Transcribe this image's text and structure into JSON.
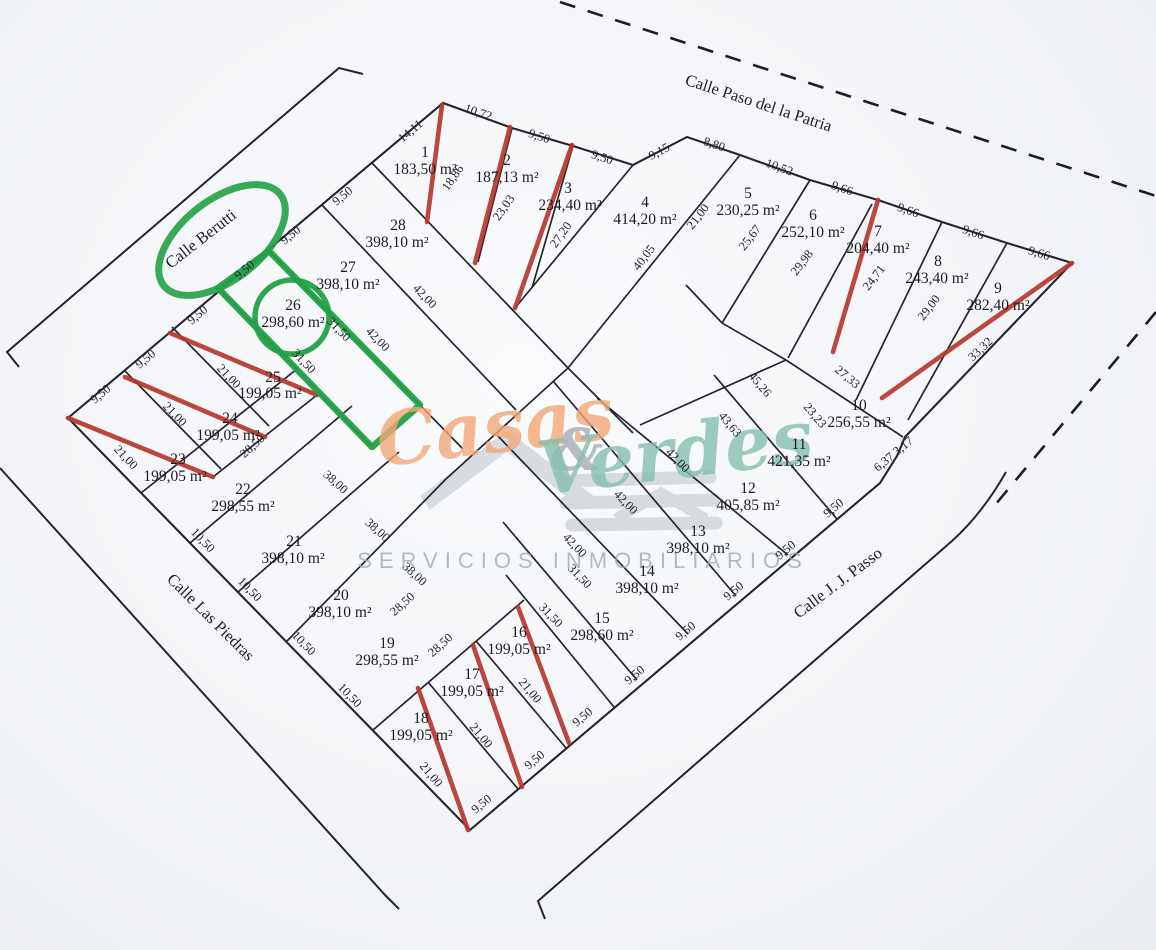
{
  "streets": [
    {
      "name": "Calle Paso del la Patria"
    },
    {
      "name": "Calle Berutti"
    },
    {
      "name": "Calle Las Piedras"
    },
    {
      "name": "Calle J. J. Passo"
    }
  ],
  "watermark": {
    "word1": "Casas",
    "amp": "&",
    "word2": "Verdes",
    "caption": "SERVICIOS INMOBILIARIOS"
  },
  "colors": {
    "ink": "#25252e",
    "sold": "#b6372c",
    "highlight": "#22a146",
    "wm_orange": "#f2a878",
    "wm_teal": "#86bfae",
    "wm_gray": "#a6adb6"
  },
  "lots": [
    {
      "num": "1",
      "area": "183,50 m²",
      "nx": 425,
      "ny": 157,
      "ax": 425,
      "ay": 174,
      "sold": true,
      "highlighted": false
    },
    {
      "num": "2",
      "area": "187,13 m²",
      "nx": 507,
      "ny": 165,
      "ax": 507,
      "ay": 182,
      "sold": true,
      "highlighted": false
    },
    {
      "num": "3",
      "area": "234,40 m²",
      "nx": 568,
      "ny": 193,
      "ax": 570,
      "ay": 210,
      "sold": true,
      "highlighted": false
    },
    {
      "num": "4",
      "area": "414,20 m²",
      "nx": 645,
      "ny": 207,
      "ax": 645,
      "ay": 224,
      "sold": false,
      "highlighted": false
    },
    {
      "num": "5",
      "area": "230,25 m²",
      "nx": 748,
      "ny": 198,
      "ax": 748,
      "ay": 215,
      "sold": false,
      "highlighted": false
    },
    {
      "num": "6",
      "area": "252,10 m²",
      "nx": 813,
      "ny": 220,
      "ax": 813,
      "ay": 237,
      "sold": false,
      "highlighted": false
    },
    {
      "num": "7",
      "area": "204,40 m²",
      "nx": 878,
      "ny": 236,
      "ax": 878,
      "ay": 253,
      "sold": true,
      "highlighted": false
    },
    {
      "num": "8",
      "area": "243,40 m²",
      "nx": 938,
      "ny": 266,
      "ax": 937,
      "ay": 283,
      "sold": false,
      "highlighted": false
    },
    {
      "num": "9",
      "area": "282,40 m²",
      "nx": 998,
      "ny": 293,
      "ax": 998,
      "ay": 310,
      "sold": true,
      "highlighted": false
    },
    {
      "num": "10",
      "area": "256,55 m²",
      "nx": 859,
      "ny": 410,
      "ax": 859,
      "ay": 427,
      "sold": false,
      "highlighted": false
    },
    {
      "num": "11",
      "area": "421,35 m²",
      "nx": 799,
      "ny": 449,
      "ax": 799,
      "ay": 466,
      "sold": false,
      "highlighted": false
    },
    {
      "num": "12",
      "area": "405,85 m²",
      "nx": 748,
      "ny": 493,
      "ax": 748,
      "ay": 510,
      "sold": false,
      "highlighted": false
    },
    {
      "num": "13",
      "area": "398,10 m²",
      "nx": 698,
      "ny": 536,
      "ax": 698,
      "ay": 553,
      "sold": false,
      "highlighted": false
    },
    {
      "num": "14",
      "area": "398,10 m²",
      "nx": 647,
      "ny": 576,
      "ax": 647,
      "ay": 593,
      "sold": false,
      "highlighted": false
    },
    {
      "num": "15",
      "area": "298,60 m²",
      "nx": 602,
      "ny": 623,
      "ax": 602,
      "ay": 640,
      "sold": false,
      "highlighted": false
    },
    {
      "num": "16",
      "area": "199,05 m²",
      "nx": 519,
      "ny": 637,
      "ax": 519,
      "ay": 654,
      "sold": true,
      "highlighted": false
    },
    {
      "num": "17",
      "area": "199,05 m²",
      "nx": 472,
      "ny": 679,
      "ax": 472,
      "ay": 696,
      "sold": true,
      "highlighted": false
    },
    {
      "num": "18",
      "area": "199,05 m²",
      "nx": 421,
      "ny": 723,
      "ax": 421,
      "ay": 740,
      "sold": true,
      "highlighted": false
    },
    {
      "num": "19",
      "area": "298,55 m²",
      "nx": 387,
      "ny": 648,
      "ax": 387,
      "ay": 665,
      "sold": false,
      "highlighted": false
    },
    {
      "num": "20",
      "area": "398,10 m²",
      "nx": 341,
      "ny": 600,
      "ax": 340,
      "ay": 617,
      "sold": false,
      "highlighted": false
    },
    {
      "num": "21",
      "area": "398,10 m²",
      "nx": 294,
      "ny": 546,
      "ax": 293,
      "ay": 563,
      "sold": false,
      "highlighted": false
    },
    {
      "num": "22",
      "area": "298,55 m²",
      "nx": 243,
      "ny": 494,
      "ax": 243,
      "ay": 511,
      "sold": false,
      "highlighted": false
    },
    {
      "num": "23",
      "area": "199,05 m²",
      "nx": 178,
      "ny": 464,
      "ax": 175,
      "ay": 481,
      "sold": true,
      "highlighted": false
    },
    {
      "num": "24",
      "area": "199,05 m²",
      "nx": 230,
      "ny": 423,
      "ax": 228,
      "ay": 440,
      "sold": true,
      "highlighted": false
    },
    {
      "num": "25",
      "area": "199,05 m²",
      "nx": 273,
      "ny": 382,
      "ax": 270,
      "ay": 398,
      "sold": true,
      "highlighted": false
    },
    {
      "num": "26",
      "area": "298,60 m²",
      "nx": 293,
      "ny": 310,
      "ax": 293,
      "ay": 327,
      "sold": false,
      "highlighted": true
    },
    {
      "num": "27",
      "area": "398,10 m²",
      "nx": 348,
      "ny": 272,
      "ax": 348,
      "ay": 289,
      "sold": false,
      "highlighted": false
    },
    {
      "num": "28",
      "area": "398,10 m²",
      "nx": 398,
      "ny": 230,
      "ax": 397,
      "ay": 247,
      "sold": false,
      "highlighted": false
    }
  ],
  "dimensions": [
    {
      "t": "9,50",
      "x": 103,
      "y": 397,
      "r": -40
    },
    {
      "t": "9,50",
      "x": 148,
      "y": 362,
      "r": -40
    },
    {
      "t": "9,50",
      "x": 200,
      "y": 318,
      "r": -40
    },
    {
      "t": "9,50",
      "x": 247,
      "y": 273,
      "r": -40
    },
    {
      "t": "9,50",
      "x": 293,
      "y": 238,
      "r": -40
    },
    {
      "t": "9,50",
      "x": 345,
      "y": 199,
      "r": -40
    },
    {
      "t": "14,11",
      "x": 413,
      "y": 134,
      "r": -40
    },
    {
      "t": "10,72",
      "x": 477,
      "y": 116,
      "r": 19
    },
    {
      "t": "9,50",
      "x": 538,
      "y": 140,
      "r": 19
    },
    {
      "t": "9,50",
      "x": 601,
      "y": 161,
      "r": 19
    },
    {
      "t": "9,15",
      "x": 661,
      "y": 155,
      "r": -28
    },
    {
      "t": "8,80",
      "x": 713,
      "y": 148,
      "r": 19
    },
    {
      "t": "10,52",
      "x": 778,
      "y": 171,
      "r": 20
    },
    {
      "t": "9,66",
      "x": 841,
      "y": 192,
      "r": 19
    },
    {
      "t": "9,66",
      "x": 907,
      "y": 214,
      "r": 19
    },
    {
      "t": "9,66",
      "x": 972,
      "y": 236,
      "r": 19
    },
    {
      "t": "9,66",
      "x": 1038,
      "y": 257,
      "r": 17
    },
    {
      "t": "33,32",
      "x": 983,
      "y": 352,
      "r": -43
    },
    {
      "t": "18,86",
      "x": 456,
      "y": 180,
      "r": -55
    },
    {
      "t": "23,03",
      "x": 507,
      "y": 210,
      "r": -55
    },
    {
      "t": "27,20",
      "x": 564,
      "y": 237,
      "r": -55
    },
    {
      "t": "40,05",
      "x": 647,
      "y": 260,
      "r": -52
    },
    {
      "t": "21,00",
      "x": 701,
      "y": 219,
      "r": -52
    },
    {
      "t": "25,67",
      "x": 753,
      "y": 240,
      "r": -52
    },
    {
      "t": "29,98",
      "x": 805,
      "y": 265,
      "r": -52
    },
    {
      "t": "24,71",
      "x": 877,
      "y": 280,
      "r": -52
    },
    {
      "t": "29,00",
      "x": 932,
      "y": 310,
      "r": -52
    },
    {
      "t": "27,33",
      "x": 845,
      "y": 380,
      "r": 40
    },
    {
      "t": "23,23",
      "x": 812,
      "y": 418,
      "r": 50
    },
    {
      "t": "6,37 3,17",
      "x": 896,
      "y": 457,
      "r": -40
    },
    {
      "t": "45,26",
      "x": 757,
      "y": 387,
      "r": 50
    },
    {
      "t": "43,63",
      "x": 727,
      "y": 427,
      "r": 50
    },
    {
      "t": "42,00",
      "x": 422,
      "y": 299,
      "r": 46
    },
    {
      "t": "42,00",
      "x": 375,
      "y": 342,
      "r": 46
    },
    {
      "t": "42,00",
      "x": 675,
      "y": 463,
      "r": 46
    },
    {
      "t": "42,00",
      "x": 623,
      "y": 505,
      "r": 46
    },
    {
      "t": "42,00",
      "x": 572,
      "y": 548,
      "r": 46
    },
    {
      "t": "31,50",
      "x": 336,
      "y": 332,
      "r": 46
    },
    {
      "t": "31,50",
      "x": 301,
      "y": 364,
      "r": 46
    },
    {
      "t": "31,50",
      "x": 577,
      "y": 579,
      "r": 46
    },
    {
      "t": "31,50",
      "x": 548,
      "y": 618,
      "r": 46
    },
    {
      "t": "38,00",
      "x": 333,
      "y": 485,
      "r": 42
    },
    {
      "t": "38,00",
      "x": 375,
      "y": 533,
      "r": 42
    },
    {
      "t": "38,00",
      "x": 412,
      "y": 577,
      "r": 42
    },
    {
      "t": "28,50",
      "x": 255,
      "y": 449,
      "r": -42
    },
    {
      "t": "28,50",
      "x": 405,
      "y": 607,
      "r": -42
    },
    {
      "t": "28,50",
      "x": 443,
      "y": 648,
      "r": -42
    },
    {
      "t": "21,00",
      "x": 226,
      "y": 379,
      "r": 46
    },
    {
      "t": "21,00",
      "x": 172,
      "y": 417,
      "r": 46
    },
    {
      "t": "21,00",
      "x": 123,
      "y": 460,
      "r": 46
    },
    {
      "t": "21,00",
      "x": 527,
      "y": 693,
      "r": 50
    },
    {
      "t": "21,00",
      "x": 478,
      "y": 738,
      "r": 50
    },
    {
      "t": "21,00",
      "x": 428,
      "y": 777,
      "r": 50
    },
    {
      "t": "9,50",
      "x": 836,
      "y": 511,
      "r": -40
    },
    {
      "t": "9,50",
      "x": 788,
      "y": 553,
      "r": -40
    },
    {
      "t": "9,50",
      "x": 736,
      "y": 594,
      "r": -40
    },
    {
      "t": "9,50",
      "x": 688,
      "y": 634,
      "r": -40
    },
    {
      "t": "9,50",
      "x": 637,
      "y": 678,
      "r": -40
    },
    {
      "t": "9,50",
      "x": 585,
      "y": 720,
      "r": -40
    },
    {
      "t": "9,50",
      "x": 537,
      "y": 763,
      "r": -40
    },
    {
      "t": "9,50",
      "x": 484,
      "y": 807,
      "r": -40
    },
    {
      "t": "10,50",
      "x": 200,
      "y": 543,
      "r": 46
    },
    {
      "t": "10,50",
      "x": 247,
      "y": 592,
      "r": 46
    },
    {
      "t": "10,50",
      "x": 301,
      "y": 646,
      "r": 46
    },
    {
      "t": "10,50",
      "x": 347,
      "y": 698,
      "r": 46
    }
  ]
}
